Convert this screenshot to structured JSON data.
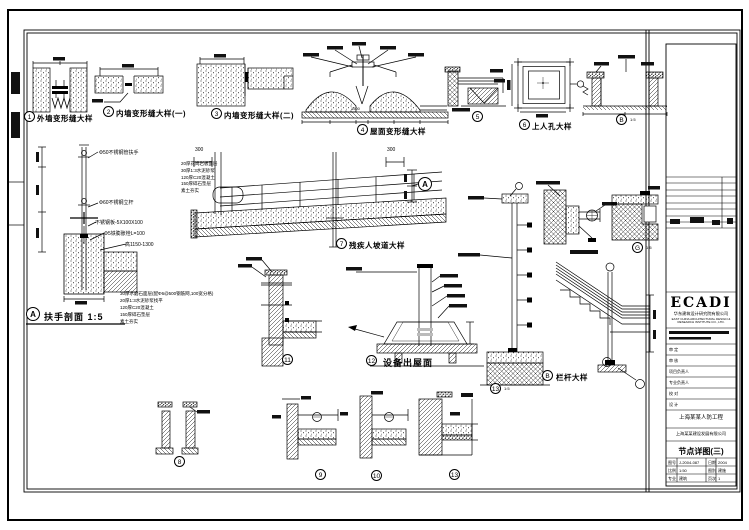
{
  "sheet": {
    "background": "#ffffff",
    "line_color": "#000000"
  },
  "details": {
    "d1": {
      "num": "1",
      "title": "外墙变形缝大样"
    },
    "d2": {
      "num": "2",
      "title": "内墙变形缝大样(一)"
    },
    "d3": {
      "num": "3",
      "title": "内墙变形缝大样(二)"
    },
    "d4": {
      "num": "4",
      "title": "屋面变形缝大样",
      "dim": "1500"
    },
    "d5": {
      "num": "5"
    },
    "d6": {
      "num": "6",
      "title": "上人孔大样"
    },
    "d7": {
      "num": "7",
      "title": "残疾人坡道大样",
      "dim_left": "300",
      "dim_right": "300",
      "section_mark": "A"
    },
    "d8": {
      "num": "8"
    },
    "d9": {
      "num": "9"
    },
    "d10": {
      "num": "10"
    },
    "d11": {
      "num": "11"
    },
    "d12": {
      "num": "12",
      "title": "设备出屋面"
    },
    "d13": {
      "num": "13",
      "scale": "1:5"
    },
    "d13b": {
      "num": "13"
    },
    "dA": {
      "num": "A",
      "title": "扶手剖面 1:5"
    },
    "dB": {
      "num": "B",
      "title": "栏杆大样"
    },
    "dPit": {
      "num": "B",
      "scale": "1:5"
    },
    "dG": {
      "num": "G",
      "scale": "1:5"
    }
  },
  "annotations": {
    "handrail": [
      "Φ50不锈钢管扶手",
      "Φ60不锈钢立杆",
      "不锈钢板-5X100X100",
      "Φ5铁膨胀栓L=100",
      "高1150-1300"
    ],
    "floor_layers": [
      "30厚水磨石面层(配Φ6@500钢筋网,100宽分格)",
      "20厚1:3水泥砂浆找平",
      "120厚C20混凝土",
      "150厚碎石垫层",
      "素土夯实"
    ],
    "ramp_layers": [
      "20厚花岗岩板面层",
      "30厚1:3水泥砂浆",
      "120厚C20混凝土",
      "150厚碎石垫层",
      "素土夯实"
    ]
  },
  "titleblock": {
    "logo": "ECADI",
    "company": "华东建筑设计研究院有限公司",
    "company_en": "EAST CHINA ARCHITECTURAL DESIGN & RESEARCH INSTITUTE CO., LTD.",
    "fields": [
      "审 定",
      "审 核",
      "项目负责人",
      "专业负责人",
      "校 对",
      "设 计"
    ],
    "project": "上海某某人防工程",
    "client": "上海某某建设发展有限公司",
    "drawing_title": "节点详图(三)",
    "table": [
      [
        "图号",
        "J-2004-087",
        "日期",
        "2004"
      ],
      [
        "比例",
        "1:50",
        "图别",
        "建施"
      ],
      [
        "专业",
        "建筑",
        "页次",
        "1"
      ]
    ]
  }
}
